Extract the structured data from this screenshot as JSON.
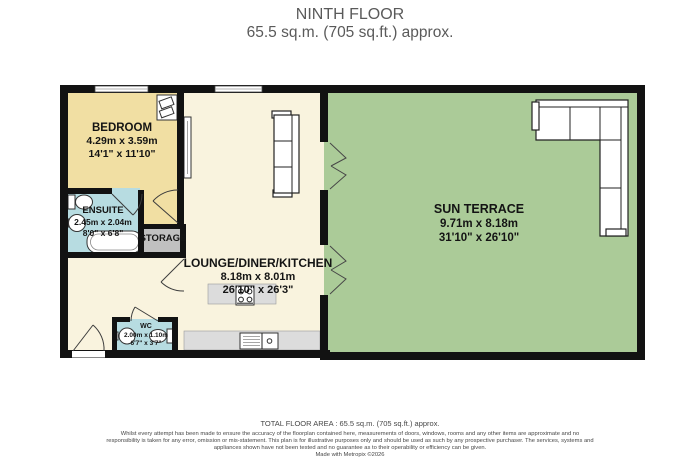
{
  "header": {
    "title": "NINTH FLOOR",
    "subtitle": "65.5 sq.m. (705 sq.ft.) approx."
  },
  "rooms": {
    "bedroom": {
      "name": "BEDROOM",
      "metric": "4.29m  x 3.59m",
      "imperial": "14'1\"  x 11'10\""
    },
    "ensuite": {
      "name": "ENSUITE",
      "metric": "2.45m  x 2.04m",
      "imperial": "8'0\"  x 6'8\""
    },
    "storage": {
      "name": "STORAGE"
    },
    "lounge": {
      "name": "LOUNGE/DINER/KITCHEN",
      "metric": "8.18m  x 8.01m",
      "imperial": "26'10\"  x 26'3\""
    },
    "wc": {
      "name": "WC",
      "metric": "2.00m  x 1.10m",
      "imperial": "6'7\"  x 3'7\""
    },
    "terrace": {
      "name": "SUN TERRACE",
      "metric": "9.71m  x 8.18m",
      "imperial": "31'10\"  x 26'10\""
    }
  },
  "footer": {
    "total_area": "TOTAL FLOOR AREA : 65.5 sq.m. (705 sq.ft.) approx.",
    "disclaimer": "Whilst every attempt has been made to ensure the accuracy of the floorplan contained here, measurements of doors, windows, rooms and any other items are approximate and no responsibility is taken for any error, omission or mis-statement. This plan is for illustrative purposes only and should be used as such by any prospective purchaser. The services, systems and appliances shown have not been tested and no guarantee as to their operability or efficiency can be given.",
    "credit": "Made with Metropix ©2026"
  },
  "colors": {
    "wall": "#121212",
    "living": "#f9f3de",
    "bedroom": "#f1dfa3",
    "bathroom": "#b7dce1",
    "terrace": "#abcb98",
    "storage": "#c0c0c0",
    "counter": "#dcdcdc"
  }
}
